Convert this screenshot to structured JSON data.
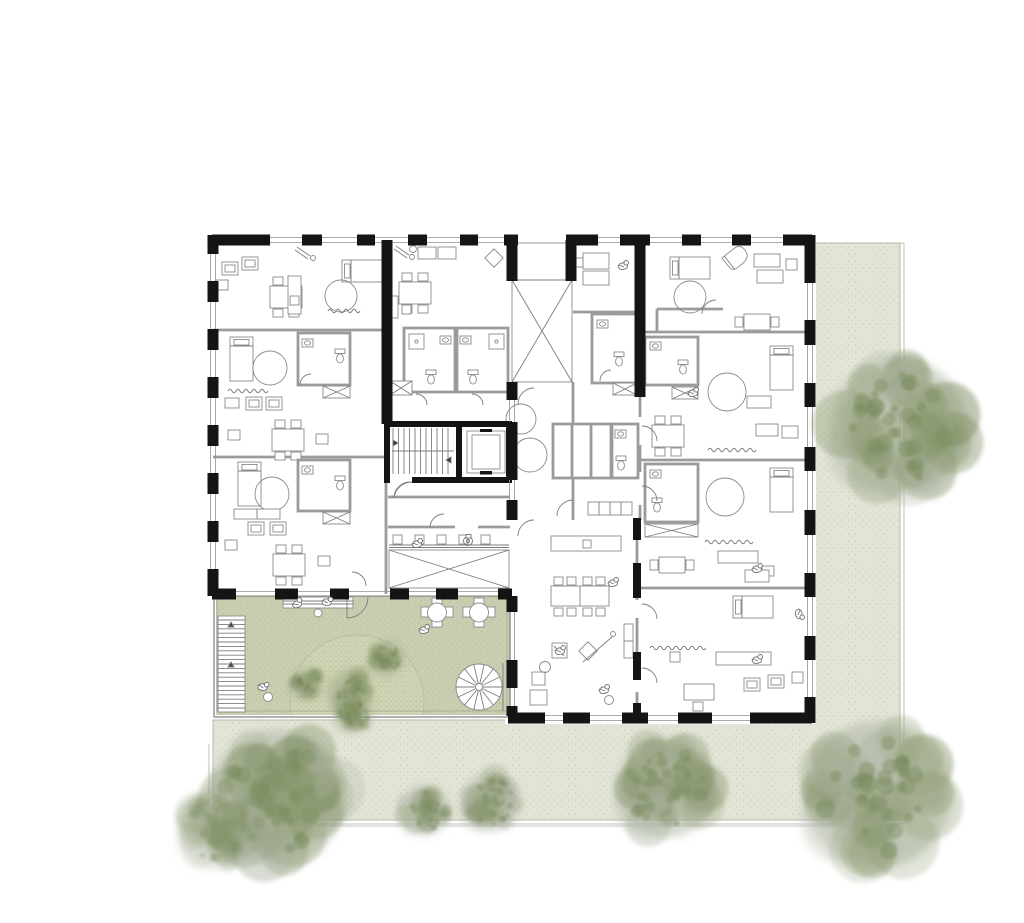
{
  "canvas": {
    "width": 1024,
    "height": 923
  },
  "palette": {
    "paper": "#ffffff",
    "wall": "#141414",
    "partition": "#9b9b9b",
    "line": "#7d7d7d",
    "light_line": "#b3b3b3",
    "furniture_line": "#8a8a8a",
    "people_line": "#6f6f6f",
    "ground": "#e3e5d7",
    "ground_speckle": "#c9cdba",
    "ground_edge": "#b5b9a8",
    "terrace": "#c9ceb1",
    "terrace_speckle": "#b4ba9a",
    "lawn": "#cfd4b5",
    "lawn_dot": "#b1b890",
    "tree_haze": "#abb3a0",
    "tree_mid": "#97a47e",
    "tree_core": "#7c8d60",
    "tree_fringe": "#bcc1b2",
    "terrace_tree_mid": "#87986a",
    "terrace_tree_core": "#6d7f4f"
  },
  "site": {
    "lawn": {
      "cx": 357,
      "cy": 702,
      "r": 67
    },
    "ground_trees": [
      {
        "x": 899,
        "y": 427,
        "r": 72,
        "seed": 11,
        "fade": 1
      },
      {
        "x": 277,
        "y": 797,
        "r": 71,
        "seed": 22,
        "fade": 1
      },
      {
        "x": 221,
        "y": 828,
        "r": 44,
        "seed": 33,
        "fade": 0.55
      },
      {
        "x": 425,
        "y": 810,
        "r": 26,
        "seed": 44,
        "fade": 1
      },
      {
        "x": 491,
        "y": 802,
        "r": 31,
        "seed": 55,
        "fade": 0.9
      },
      {
        "x": 666,
        "y": 788,
        "r": 52,
        "seed": 66,
        "fade": 1
      },
      {
        "x": 878,
        "y": 794,
        "r": 77,
        "seed": 77,
        "fade": 1
      }
    ],
    "terrace_trees": [
      {
        "x": 307,
        "y": 684,
        "r": 16,
        "seed": 101,
        "fade": 1
      },
      {
        "x": 350,
        "y": 691,
        "r": 22,
        "seed": 102,
        "fade": 1
      },
      {
        "x": 387,
        "y": 658,
        "r": 18,
        "seed": 103,
        "fade": 1
      },
      {
        "x": 354,
        "y": 714,
        "r": 19,
        "seed": 104,
        "fade": 1
      }
    ]
  }
}
